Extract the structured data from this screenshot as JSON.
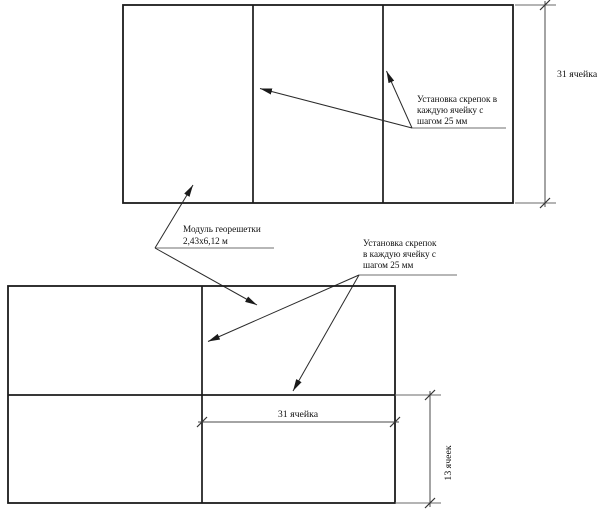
{
  "labels": {
    "staples_top": {
      "lines": [
        "Установка скрепок в",
        "каждую ячейку с",
        "шагом 25 мм"
      ]
    },
    "module": {
      "lines": [
        "Модуль георешетки",
        "2,43х6,12 м"
      ]
    },
    "staples_bottom": {
      "lines": [
        "Установка скрепок",
        "в каждую ячейку с",
        "шагом 25 мм"
      ]
    }
  },
  "dimensions": {
    "top_height": "31 ячейка",
    "bottom_width": "31 ячейка",
    "bottom_height": "13 ячеек"
  },
  "colors": {
    "background": "#ffffff",
    "outline": "#1b1b1b",
    "dimension_line": "#4a4a4a",
    "underline": "#8c8c8c",
    "text": "#101010"
  }
}
